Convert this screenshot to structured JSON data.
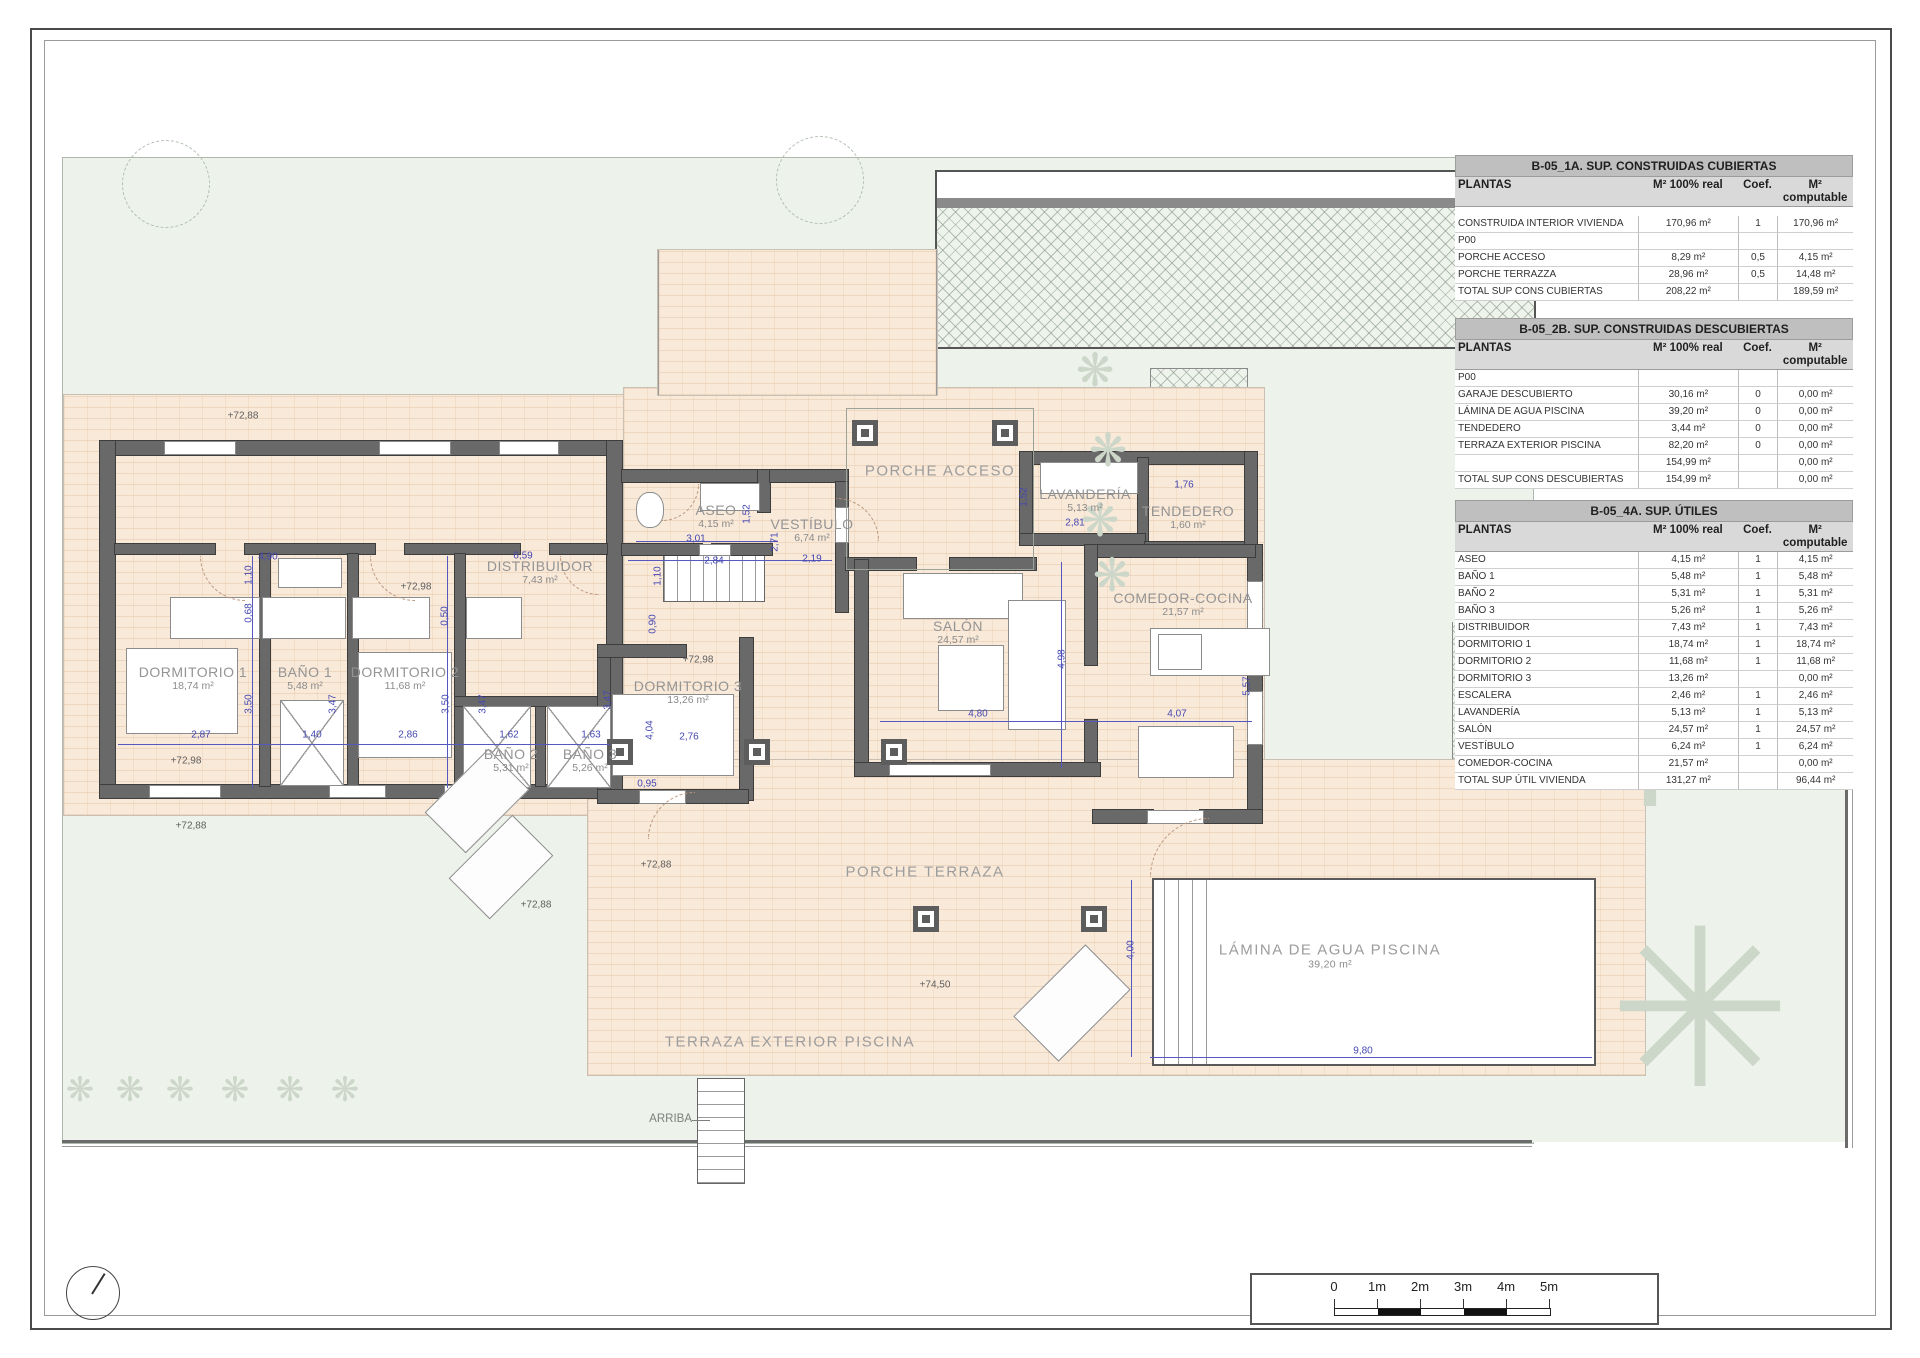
{
  "colors": {
    "dim_blue": "#4547b2",
    "wall_gray": "#696969",
    "floor_peach": "#f8e9d9",
    "garden_green": "#edf3ea",
    "table_title_bg": "#bfbfbf",
    "table_header_bg": "#d9d9d9"
  },
  "tables": [
    {
      "title": "B-05_1A. SUP. CONSTRUIDAS CUBIERTAS",
      "columns": [
        "PLANTAS",
        "M² 100% real",
        "Coef.",
        "M² computable"
      ],
      "rows": [
        [
          "CONSTRUIDA INTERIOR VIVIENDA",
          "170,96 m²",
          "1",
          "170,96 m²"
        ],
        [
          "P00",
          "",
          "",
          ""
        ],
        [
          "PORCHE ACCESO",
          "8,29 m²",
          "0,5",
          "4,15 m²"
        ],
        [
          "PORCHE TERRAZZA",
          "28,96 m²",
          "0,5",
          "14,48 m²"
        ],
        [
          "TOTAL SUP CONS CUBIERTAS",
          "208,22 m²",
          "",
          "189,59 m²"
        ]
      ]
    },
    {
      "title": "B-05_2B. SUP. CONSTRUIDAS DESCUBIERTAS",
      "columns": [
        "PLANTAS",
        "M² 100% real",
        "Coef.",
        "M² computable"
      ],
      "rows": [
        [
          "P00",
          "",
          "",
          ""
        ],
        [
          "GARAJE DESCUBIERTO",
          "30,16 m²",
          "0",
          "0,00 m²"
        ],
        [
          "LÁMINA DE AGUA PISCINA",
          "39,20 m²",
          "0",
          "0,00 m²"
        ],
        [
          "TENDEDERO",
          "3,44 m²",
          "0",
          "0,00 m²"
        ],
        [
          "TERRAZA EXTERIOR PISCINA",
          "82,20 m²",
          "0",
          "0,00 m²"
        ],
        [
          "",
          "154,99 m²",
          "",
          "0,00 m²"
        ],
        [
          "TOTAL SUP CONS DESCUBIERTAS",
          "154,99 m²",
          "",
          "0,00 m²"
        ]
      ]
    },
    {
      "title": "B-05_4A. SUP. ÚTILES",
      "columns": [
        "PLANTAS",
        "M² 100% real",
        "Coef.",
        "M² computable"
      ],
      "rows": [
        [
          "ASEO",
          "4,15 m²",
          "1",
          "4,15 m²"
        ],
        [
          "BAÑO 1",
          "5,48 m²",
          "1",
          "5,48 m²"
        ],
        [
          "BAÑO 2",
          "5,31 m²",
          "1",
          "5,31 m²"
        ],
        [
          "BAÑO 3",
          "5,26 m²",
          "1",
          "5,26 m²"
        ],
        [
          "DISTRIBUIDOR",
          "7,43 m²",
          "1",
          "7,43 m²"
        ],
        [
          "DORMITORIO 1",
          "18,74 m²",
          "1",
          "18,74 m²"
        ],
        [
          "DORMITORIO 2",
          "11,68 m²",
          "1",
          "11,68 m²"
        ],
        [
          "DORMITORIO 3",
          "13,26 m²",
          "",
          "0,00 m²"
        ],
        [
          "ESCALERA",
          "2,46 m²",
          "1",
          "2,46 m²"
        ],
        [
          "LAVANDERÍA",
          "5,13 m²",
          "1",
          "5,13 m²"
        ],
        [
          "SALÓN",
          "24,57 m²",
          "1",
          "24,57 m²"
        ],
        [
          "VESTÍBULO",
          "6,24 m²",
          "1",
          "6,24 m²"
        ],
        [
          "COMEDOR-COCINA",
          "21,57 m²",
          "",
          "0,00 m²"
        ],
        [
          "TOTAL SUP ÚTIL VIVIENDA",
          "131,27 m²",
          "",
          "96,44 m²"
        ]
      ]
    }
  ],
  "plan": {
    "rooms": [
      {
        "label": "DORMITORIO 1",
        "area": "18,74 m²",
        "x": 193,
        "y": 678
      },
      {
        "label": "BAÑO 1",
        "area": "5,48 m²",
        "x": 305,
        "y": 678
      },
      {
        "label": "DORMITORIO 2",
        "area": "11,68 m²",
        "x": 405,
        "y": 678
      },
      {
        "label": "BAÑO 2",
        "area": "5,31 m²",
        "x": 511,
        "y": 760
      },
      {
        "label": "BAÑO 3",
        "area": "5,26 m²",
        "x": 590,
        "y": 760
      },
      {
        "label": "DORMITORIO 3",
        "area": "13,26 m²",
        "x": 688,
        "y": 692
      },
      {
        "label": "DISTRIBUIDOR",
        "area": "7,43 m²",
        "x": 540,
        "y": 572
      },
      {
        "label": "ASEO",
        "area": "4,15 m²",
        "x": 716,
        "y": 516
      },
      {
        "label": "VESTÍBULO",
        "area": "6,74 m²",
        "x": 812,
        "y": 530
      },
      {
        "label": "SALÓN",
        "area": "24,57 m²",
        "x": 958,
        "y": 632
      },
      {
        "label": "COMEDOR-COCINA",
        "area": "21,57 m²",
        "x": 1183,
        "y": 604
      },
      {
        "label": "LAVANDERÍA",
        "area": "5,13 m²",
        "x": 1085,
        "y": 500
      },
      {
        "label": "TENDEDERO",
        "area": "1,60 m²",
        "x": 1188,
        "y": 517
      }
    ],
    "zones": [
      {
        "label": "PORCHE ACCESO",
        "x": 940,
        "y": 471
      },
      {
        "label": "PORCHE TERRAZA",
        "x": 925,
        "y": 872
      },
      {
        "label": "TERRAZA EXTERIOR PISCINA",
        "x": 790,
        "y": 1042
      },
      {
        "label": "LÁMINA DE AGUA PISCINA",
        "area": "39,20 m²",
        "x": 1330,
        "y": 956
      }
    ],
    "dims": [
      {
        "t": "4,90",
        "x": 268,
        "y": 557
      },
      {
        "t": "6,59",
        "x": 523,
        "y": 556
      },
      {
        "t": "2,84",
        "x": 714,
        "y": 561
      },
      {
        "t": "3,01",
        "x": 696,
        "y": 539
      },
      {
        "t": "2,19",
        "x": 812,
        "y": 559
      },
      {
        "t": "2,81",
        "x": 1075,
        "y": 523
      },
      {
        "t": "1,76",
        "x": 1184,
        "y": 485
      },
      {
        "t": "2,87",
        "x": 201,
        "y": 735
      },
      {
        "t": "1,40",
        "x": 312,
        "y": 735
      },
      {
        "t": "2,86",
        "x": 408,
        "y": 735
      },
      {
        "t": "1,62",
        "x": 509,
        "y": 735
      },
      {
        "t": "1,63",
        "x": 591,
        "y": 735
      },
      {
        "t": "2,76",
        "x": 689,
        "y": 737
      },
      {
        "t": "4,80",
        "x": 978,
        "y": 714
      },
      {
        "t": "4,07",
        "x": 1177,
        "y": 714
      },
      {
        "t": "9,80",
        "x": 1363,
        "y": 1051
      },
      {
        "t": "0,95",
        "x": 647,
        "y": 784
      },
      {
        "t": "1,10",
        "x": 249,
        "y": 575,
        "v": 1
      },
      {
        "t": "0,68",
        "x": 249,
        "y": 613,
        "v": 1
      },
      {
        "t": "3,50",
        "x": 249,
        "y": 704,
        "v": 1
      },
      {
        "t": "3,47",
        "x": 333,
        "y": 704,
        "v": 1
      },
      {
        "t": "3,50",
        "x": 446,
        "y": 704,
        "v": 1
      },
      {
        "t": "3,47",
        "x": 483,
        "y": 704,
        "v": 1
      },
      {
        "t": "0,50",
        "x": 445,
        "y": 616,
        "v": 1
      },
      {
        "t": "1,52",
        "x": 747,
        "y": 514,
        "v": 1
      },
      {
        "t": "2,71",
        "x": 775,
        "y": 542,
        "v": 1
      },
      {
        "t": "1,10",
        "x": 658,
        "y": 576,
        "v": 1
      },
      {
        "t": "0,90",
        "x": 653,
        "y": 624,
        "v": 1
      },
      {
        "t": "1,52",
        "x": 1024,
        "y": 497,
        "v": 1
      },
      {
        "t": "4,98",
        "x": 1062,
        "y": 659,
        "v": 1
      },
      {
        "t": "5,57",
        "x": 1247,
        "y": 686,
        "v": 1
      },
      {
        "t": "4,00",
        "x": 1131,
        "y": 950,
        "v": 1
      },
      {
        "t": "3,47",
        "x": 608,
        "y": 700,
        "v": 1
      },
      {
        "t": "4,04",
        "x": 650,
        "y": 730,
        "v": 1
      }
    ],
    "levels": [
      {
        "t": "+72,88",
        "x": 243,
        "y": 416
      },
      {
        "t": "+72,98",
        "x": 416,
        "y": 587
      },
      {
        "t": "+72,98",
        "x": 186,
        "y": 761
      },
      {
        "t": "+72,88",
        "x": 191,
        "y": 826
      },
      {
        "t": "+72,98",
        "x": 698,
        "y": 660
      },
      {
        "t": "+72,88",
        "x": 656,
        "y": 865
      },
      {
        "t": "+72,88",
        "x": 536,
        "y": 905
      },
      {
        "t": "+74,50",
        "x": 935,
        "y": 985
      }
    ],
    "arriba_label": "ARRIBA"
  },
  "scalebar": {
    "labels": [
      "0",
      "1m",
      "2m",
      "3m",
      "4m",
      "5m"
    ]
  }
}
